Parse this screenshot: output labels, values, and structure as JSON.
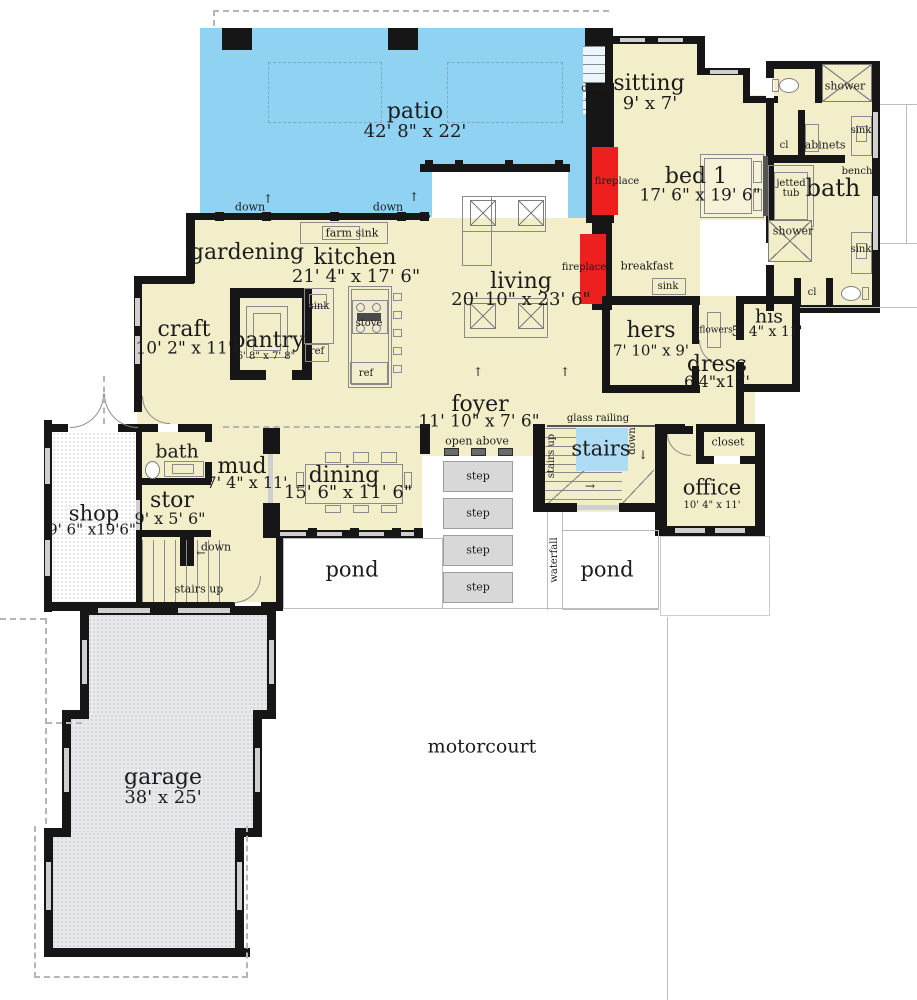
{
  "rooms": {
    "patio": {
      "name": "patio",
      "dims": "42' 8\" x 22'"
    },
    "sitting": {
      "name": "sitting",
      "dims": "9' x 7'"
    },
    "bed1": {
      "name": "bed 1",
      "dims": "17' 6\" x 19' 6\""
    },
    "bath_main": {
      "name": "bath"
    },
    "gardening": {
      "name": "gardening"
    },
    "kitchen": {
      "name": "kitchen",
      "dims": "21' 4\" x 17' 6\""
    },
    "craft": {
      "name": "craft",
      "dims": "10' 2\" x 11'"
    },
    "pantry": {
      "name": "pantry",
      "dims": "6' 8\" x 7' 8\""
    },
    "living": {
      "name": "living",
      "dims": "20' 10\" x 23' 6\""
    },
    "breakfast": {
      "name": "breakfast"
    },
    "hers": {
      "name": "hers",
      "dims": "7' 10\" x 9'"
    },
    "his": {
      "name": "his",
      "dims": "5' 4\" x 11'"
    },
    "dress": {
      "name": "dress",
      "dims": "6'4\"x17'"
    },
    "foyer": {
      "name": "foyer",
      "dims": "11' 10\" x 7' 6\""
    },
    "stairs": {
      "name": "stairs"
    },
    "office": {
      "name": "office",
      "dims": "10' 4\" x 11'"
    },
    "closet": {
      "name": "closet"
    },
    "bath2": {
      "name": "bath"
    },
    "mud": {
      "name": "mud",
      "dims": "7' 4\" x 11'"
    },
    "stor": {
      "name": "stor",
      "dims": "9' x 5' 6\""
    },
    "dining": {
      "name": "dining",
      "dims": "15' 6\" x 11' 6\""
    },
    "shop": {
      "name": "shop",
      "dims": "9' 6\" x19'6\""
    },
    "garage": {
      "name": "garage",
      "dims": "38' x 25'"
    },
    "pond": {
      "name": "pond"
    },
    "motorcourt": {
      "name": "motorcourt"
    }
  },
  "fixtures": {
    "farm_sink": "farm sink",
    "sink": "sink",
    "stove": "stove",
    "ref": "ref",
    "fireplace": "fireplace",
    "shower": "shower",
    "cabinets": "cabinets",
    "jetted_tub": "jetted tub",
    "bench": "bench",
    "cl": "cl",
    "flowers": "flowers",
    "step": "step",
    "waterfall": "waterfall",
    "glass_railing": "glass railing",
    "stairs_up": "stairs up",
    "down": "down",
    "open_above": "open above"
  },
  "icons": {
    "up_arrow": "↑",
    "down_arrow": "↓",
    "left_arrow": "←",
    "right_arrow": "→"
  },
  "colors": {
    "room_fill": "#f2eec9",
    "patio_blue": "#8fd2f2",
    "stairs_blue": "#aedcf5",
    "fireplace_red": "#ee1f1f",
    "wall": "#161616",
    "step_gray": "#d8d8d8",
    "garage_gray": "#e7e9ec"
  }
}
